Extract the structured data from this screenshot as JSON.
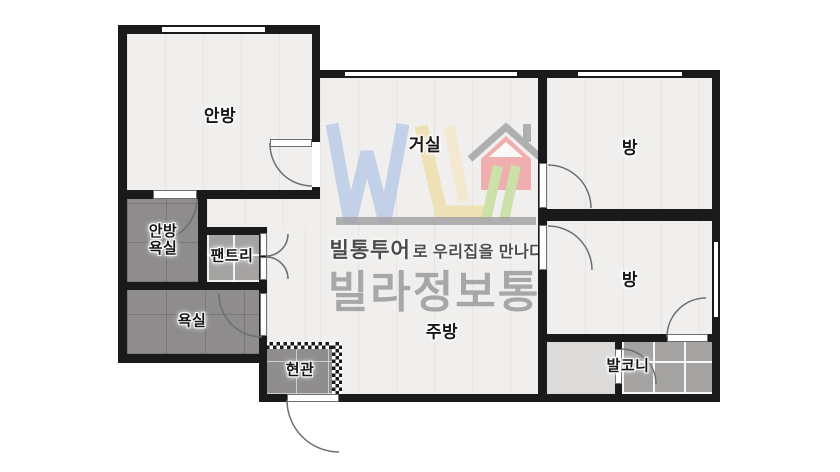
{
  "plan_title": "apartment-floor-plan",
  "rooms": [
    {
      "id": "anbang",
      "label": "안방"
    },
    {
      "id": "geosil",
      "label": "거실"
    },
    {
      "id": "bang_top",
      "label": "방"
    },
    {
      "id": "bang_mid",
      "label": "방"
    },
    {
      "id": "anbang_yoksil",
      "label": "안방\n욕실"
    },
    {
      "id": "pantry",
      "label": "팬트리"
    },
    {
      "id": "yoksil",
      "label": "욕실"
    },
    {
      "id": "jubang",
      "label": "주방"
    },
    {
      "id": "hyeongwan",
      "label": "현관"
    },
    {
      "id": "balkoni",
      "label": "발코니"
    }
  ],
  "watermark": {
    "tagline_brand": "빌통투어",
    "tagline_rest": "로 우리집을 만나다",
    "brand": "빌라정보통"
  },
  "colors": {
    "wall": "#1a1a1a",
    "floor_light": "#f0efed",
    "tile_dark": "#8e8c8c",
    "tile_mid": "#a5a3a2",
    "balcony_light": "#dcdbd9",
    "logo_blue": "#b7c9e6",
    "logo_yellow": "#eedfac",
    "logo_green": "#c9dfa2",
    "logo_pink": "#efa9a9",
    "logo_gray": "#a3a3a3",
    "brand_text": "#a7a7a7",
    "tagline_text": "#4c4c4c"
  }
}
